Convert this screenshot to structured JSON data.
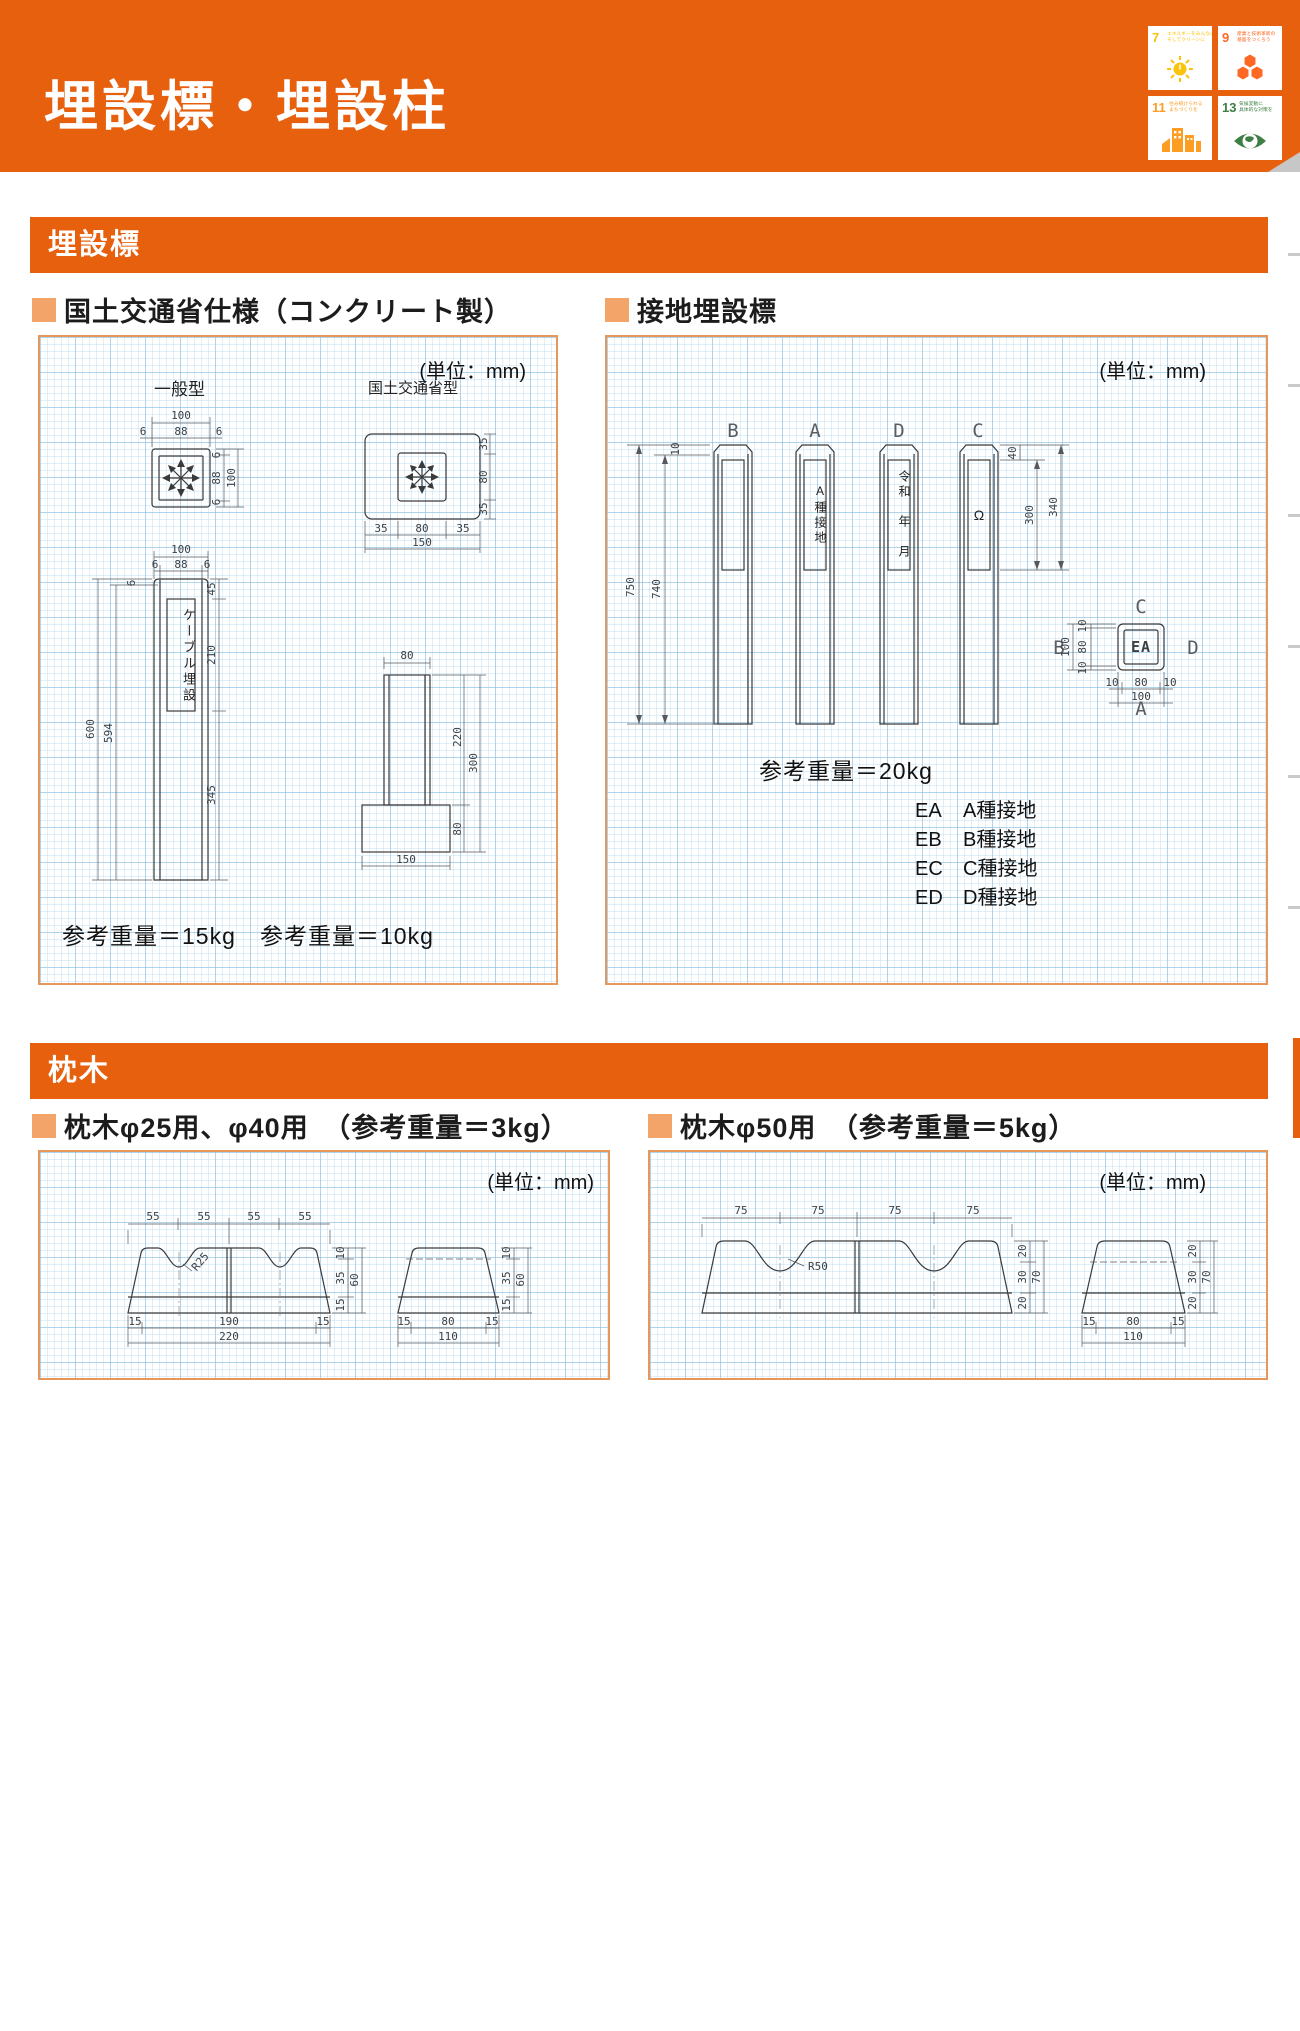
{
  "colors": {
    "orange": "#e7600e",
    "bullet": "#f2a469",
    "panel-border": "#e8975a",
    "sdg7": "#FCC30B",
    "sdg9": "#FD6925",
    "sdg11": "#FD9D24",
    "sdg13": "#3F7E44"
  },
  "header": {
    "title": "埋設標・埋設柱"
  },
  "sdg": {
    "tiles": [
      {
        "num": "7",
        "line1": "エネルギーをみんなに",
        "line2": "そしてクリーンに"
      },
      {
        "num": "9",
        "line1": "産業と技術革新の",
        "line2": "基盤をつくろう"
      },
      {
        "num": "11",
        "line1": "住み続けられる",
        "line2": "まちづくりを"
      },
      {
        "num": "13",
        "line1": "気候変動に",
        "line2": "具体的な対策を"
      }
    ]
  },
  "sec1": {
    "bar": "埋設標",
    "left": {
      "heading": "国土交通省仕様（コンクリート製）",
      "unit": "(単位：mm)",
      "label_general": "一般型",
      "label_mlit": "国土交通省型",
      "plate": "ケーブル埋設",
      "weight_general": "参考重量＝15kg",
      "weight_mlit": "参考重量＝10kg",
      "gtop": {
        "w": "100",
        "wi": "88",
        "w6l": "6",
        "w6r": "6",
        "h6t": "6",
        "hi": "88",
        "h": "100",
        "h6b": "6"
      },
      "gfront": {
        "w": "100",
        "wi": "88",
        "w6l": "6",
        "w6r": "6",
        "h600": "600",
        "h594": "594",
        "t6": "6",
        "r45": "45",
        "r210": "210",
        "r345": "345"
      },
      "mtop": {
        "v35t": "35",
        "v80": "80",
        "v35b": "35",
        "h35l": "35",
        "h80": "80",
        "h35r": "35",
        "h150": "150"
      },
      "mside": {
        "t80": "80",
        "r220": "220",
        "r80": "80",
        "r300": "300",
        "b150": "150"
      }
    },
    "right": {
      "heading": "接地埋設標",
      "unit": "(単位：mm)",
      "posts": [
        {
          "letter": "B",
          "label": ""
        },
        {
          "letter": "A",
          "label": "A種接地"
        },
        {
          "letter": "D",
          "label": "令和　年　月"
        },
        {
          "letter": "C",
          "label": "Ω"
        }
      ],
      "dims": {
        "d10": "10",
        "d750": "750",
        "d740": "740",
        "d40": "40",
        "d300": "300",
        "d340": "340"
      },
      "plan": {
        "center": "EA",
        "top": "C",
        "left": "B",
        "right": "D",
        "bottom": "A",
        "l100": "100",
        "l10t": "10",
        "l80": "80",
        "l10b": "10",
        "b10l": "10",
        "b80": "80",
        "b10r": "10",
        "b100": "100"
      },
      "weight": "参考重量＝20kg",
      "legend": [
        {
          "code": "EA",
          "desc": "A種接地"
        },
        {
          "code": "EB",
          "desc": "B種接地"
        },
        {
          "code": "EC",
          "desc": "C種接地"
        },
        {
          "code": "ED",
          "desc": "D種接地"
        }
      ]
    }
  },
  "sec2": {
    "bar": "枕木",
    "left": {
      "heading": "枕木φ25用、φ40用　（参考重量＝3kg）",
      "unit": "(単位：mm)",
      "front": {
        "t": [
          "55",
          "55",
          "55",
          "55"
        ],
        "r": "R25",
        "s10": "10",
        "s35": "35",
        "s15": "15",
        "s60": "60",
        "b15l": "15",
        "b190": "190",
        "b15r": "15",
        "b220": "220"
      },
      "side": {
        "s10": "10",
        "s35": "35",
        "s15": "15",
        "s60": "60",
        "b15l": "15",
        "b80": "80",
        "b15r": "15",
        "b110": "110"
      }
    },
    "right": {
      "heading": "枕木φ50用　（参考重量＝5kg）",
      "unit": "(単位：mm)",
      "front": {
        "t": [
          "75",
          "75",
          "75",
          "75"
        ],
        "r": "R50",
        "s20t": "20",
        "s30": "30",
        "s20b": "20",
        "s70": "70"
      },
      "side": {
        "s20t": "20",
        "s30": "30",
        "s20b": "20",
        "s70": "70",
        "b15l": "15",
        "b80": "80",
        "b15r": "15",
        "b110": "110"
      }
    }
  }
}
